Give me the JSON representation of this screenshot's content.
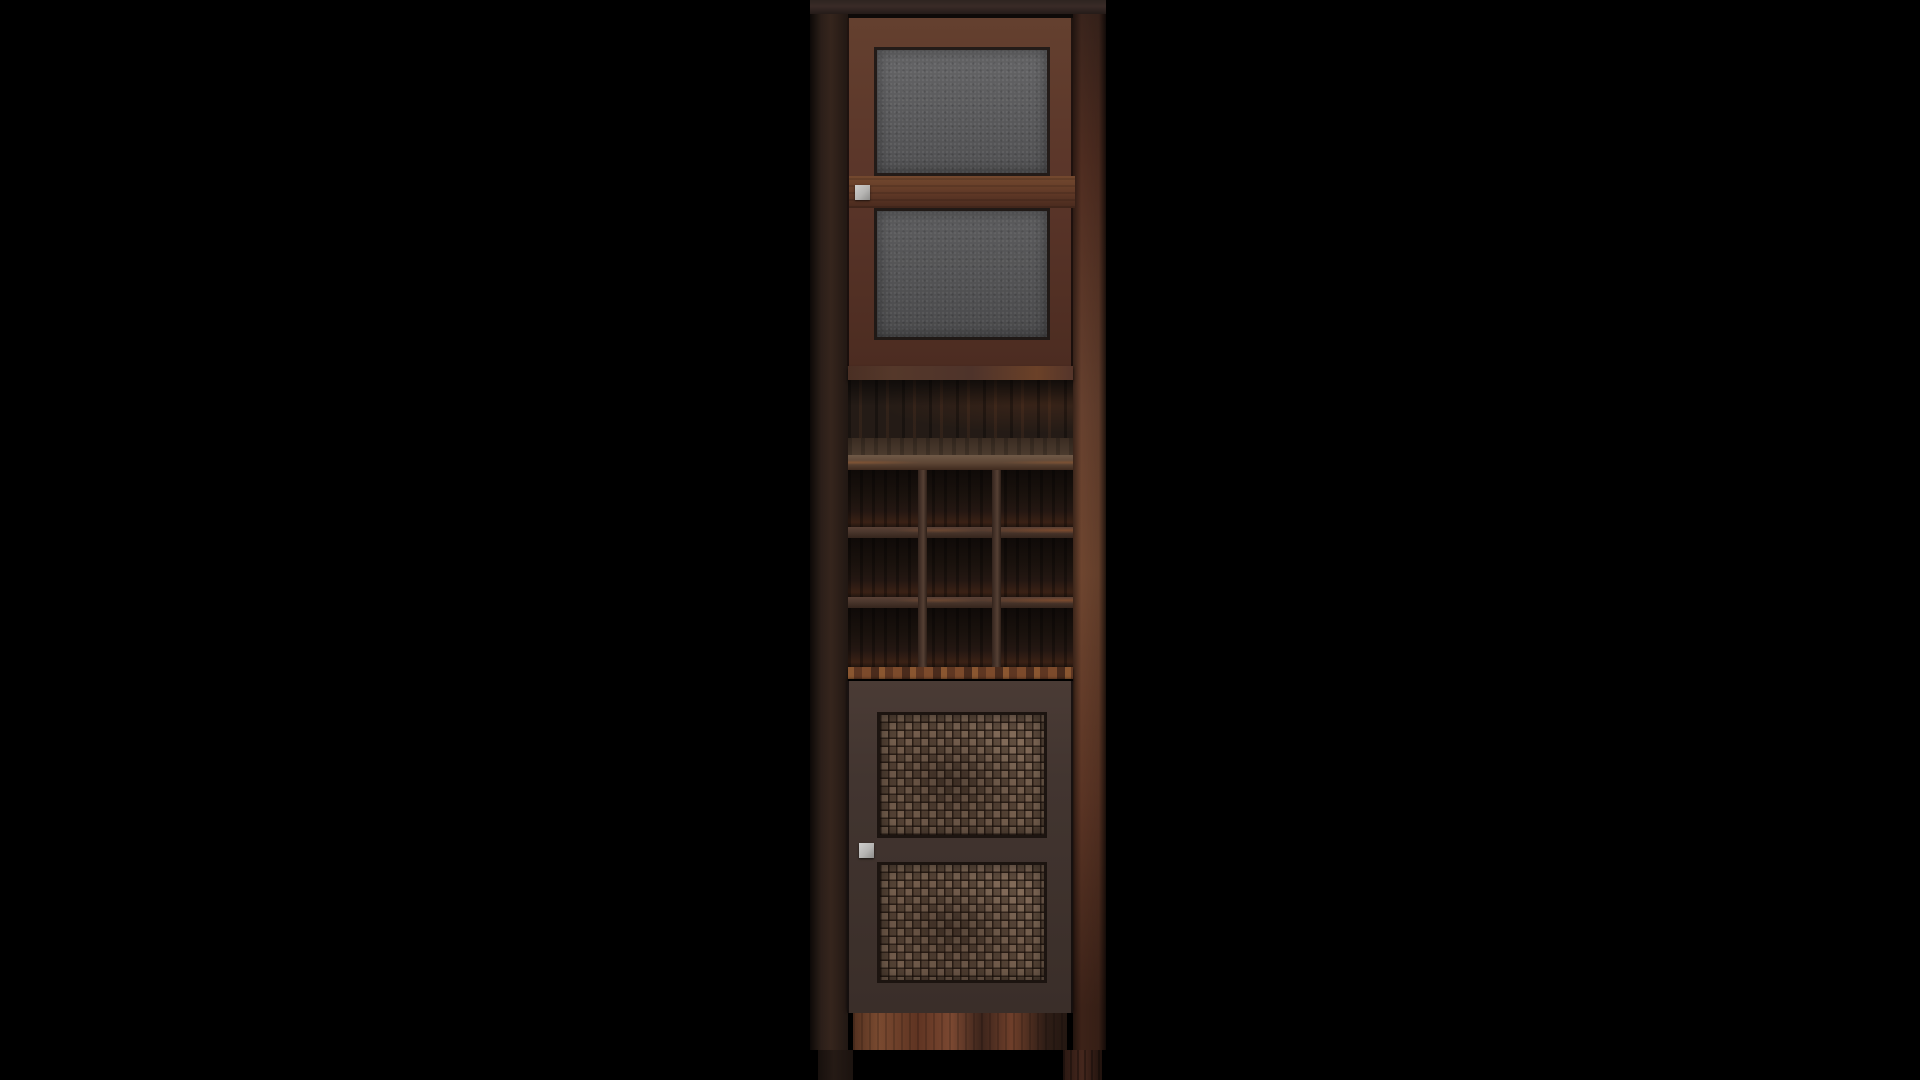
{
  "scene": {
    "background_color": "#000000",
    "object": "tall wine cabinet",
    "view": "front",
    "style": "3d product render on black backdrop"
  },
  "cabinet": {
    "structure": {
      "top_section": {
        "type": "frosted-glass door",
        "panes": 2,
        "handle_position": "left-middle"
      },
      "divider": {
        "type": "fixed shelf board"
      },
      "open_compartment": {
        "type": "open shelf niche"
      },
      "wine_rack": {
        "rows": 3,
        "columns": 3,
        "openings": 9
      },
      "bottom_section": {
        "type": "woven-wicker door",
        "panels": 2,
        "handle_position": "left-middle"
      },
      "base": {
        "type": "apron rail",
        "legs_visible": 2
      }
    },
    "palette": {
      "top_board": "#2e2420",
      "left_stile": "#33241d",
      "right_stile": "#5a3526",
      "door_frame": "#5d382c",
      "door_rail_highlight": "#74492f",
      "glass": "#5b5b5d",
      "glass_bevel": "#231b18",
      "handle": "#b5b4b2",
      "divider_board": "#55382a",
      "interior": "#241b16",
      "shelf_top": "#44352a",
      "shelf_front": "#6f5947",
      "rack_divider": "#4a362c",
      "rack_shelf": "#7c4a2b",
      "lower_door_frame": "#423530",
      "wicker": "#6d5645",
      "wicker_gap": "#1c1410",
      "apron": "#6f3f2a",
      "leg_left": "#251a15",
      "leg_right": "#45271d"
    }
  }
}
